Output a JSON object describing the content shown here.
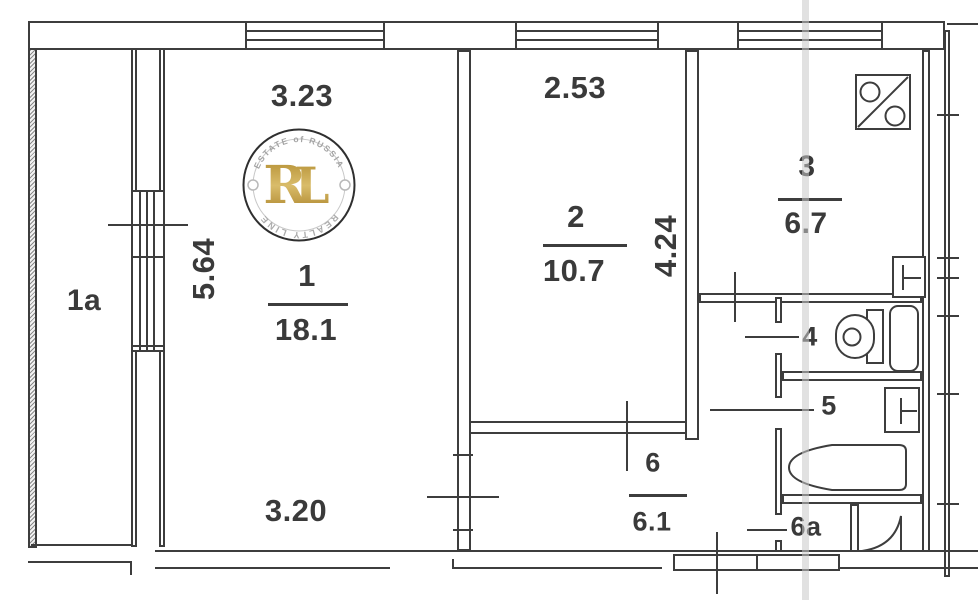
{
  "rooms": {
    "balcony": {
      "label": "1a"
    },
    "living": {
      "number": "1",
      "area": "18.1"
    },
    "bedroom": {
      "number": "2",
      "area": "10.7"
    },
    "kitchen": {
      "number": "3",
      "area": "6.7"
    },
    "wc": {
      "number": "4"
    },
    "bathroom": {
      "number": "5"
    },
    "hallway": {
      "number": "6",
      "area": "6.1"
    },
    "storage": {
      "number": "6a"
    }
  },
  "dimensions": {
    "living_top_width": "3.23",
    "living_left_height": "5.64",
    "living_bottom_width": "3.20",
    "bedroom_top_width": "2.53",
    "bedroom_right_height": "4.24"
  },
  "watermark": {
    "arc_top": "ESTATE of RUSSIA",
    "arc_bottom": "REALTY LINE",
    "monogram_r": "R",
    "monogram_l": "L",
    "gold_color": "#b6913a"
  },
  "icons": {
    "stove": "stove-vent-icon",
    "kitchen_sink": "sink-icon",
    "toilet": "toilet-icon",
    "washbasin": "washbasin-icon",
    "bathtub": "bathtub-icon",
    "corner_fixture": "corner-shower-icon"
  },
  "line_color": "#3d3d3d"
}
